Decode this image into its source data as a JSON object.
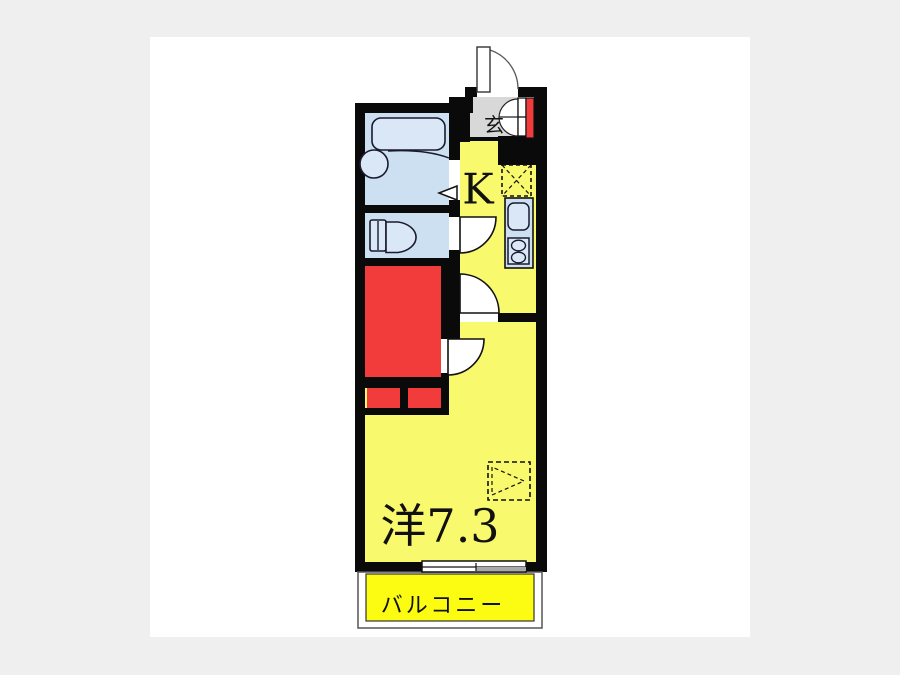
{
  "page": {
    "background": "#efefef",
    "canvas_background": "#ffffff"
  },
  "floor_plan": {
    "type": "japanese-apartment-floorplan",
    "labels": {
      "entrance": "玄",
      "kitchen": "K",
      "western_room": "洋7.3",
      "balcony": "バルコニー"
    },
    "colors": {
      "wall": "#0a0a0a",
      "room_yellow": "#f9f96d",
      "balcony_yellow": "#fcfc12",
      "wet_area_blue": "#cde0f2",
      "fixture_blue": "#d9e7f6",
      "closet_red": "#f23b3b",
      "entrance_gray": "#d8d8d8",
      "window_gray": "#a9a9a9",
      "line": "#1a1a1a"
    }
  }
}
